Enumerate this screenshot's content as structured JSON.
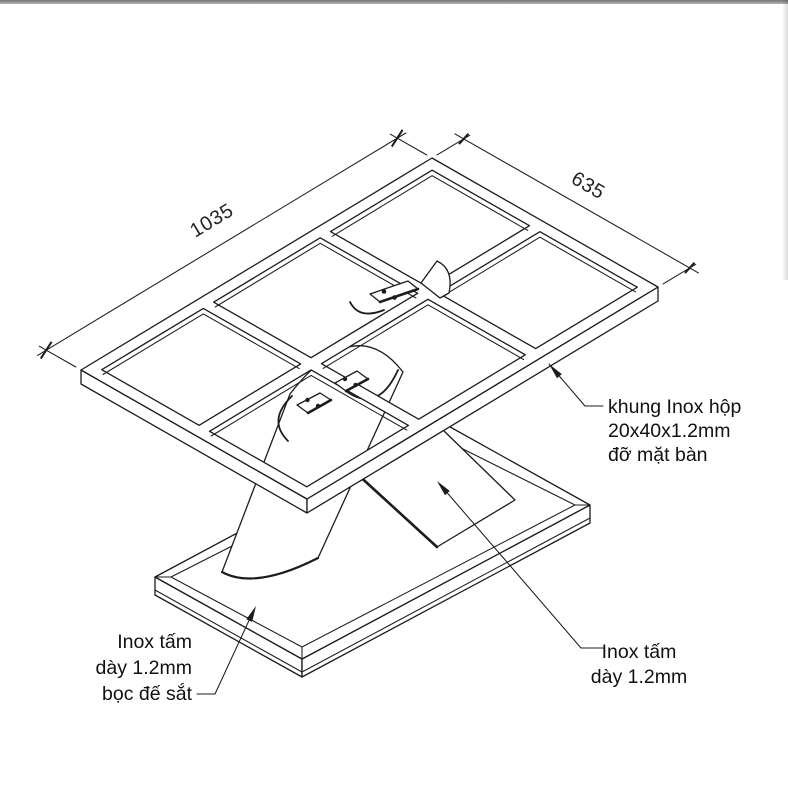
{
  "page": {
    "background": "#ffffff",
    "top_bar_color": "#767676"
  },
  "drawing": {
    "line_color": "#1c1c1c",
    "dimensions": [
      {
        "id": "length",
        "label": "1035"
      },
      {
        "id": "width",
        "label": "635"
      }
    ],
    "annotations": {
      "frame_note": {
        "lines": [
          "khung Inox hộp",
          "20x40x1.2mm",
          "đỡ mặt bàn"
        ]
      },
      "base_note": {
        "lines": [
          "Inox tấm",
          "dày 1.2mm",
          "bọc đế sắt"
        ]
      },
      "leg_note": {
        "lines": [
          "Inox tấm",
          "dày 1.2mm"
        ]
      }
    }
  }
}
